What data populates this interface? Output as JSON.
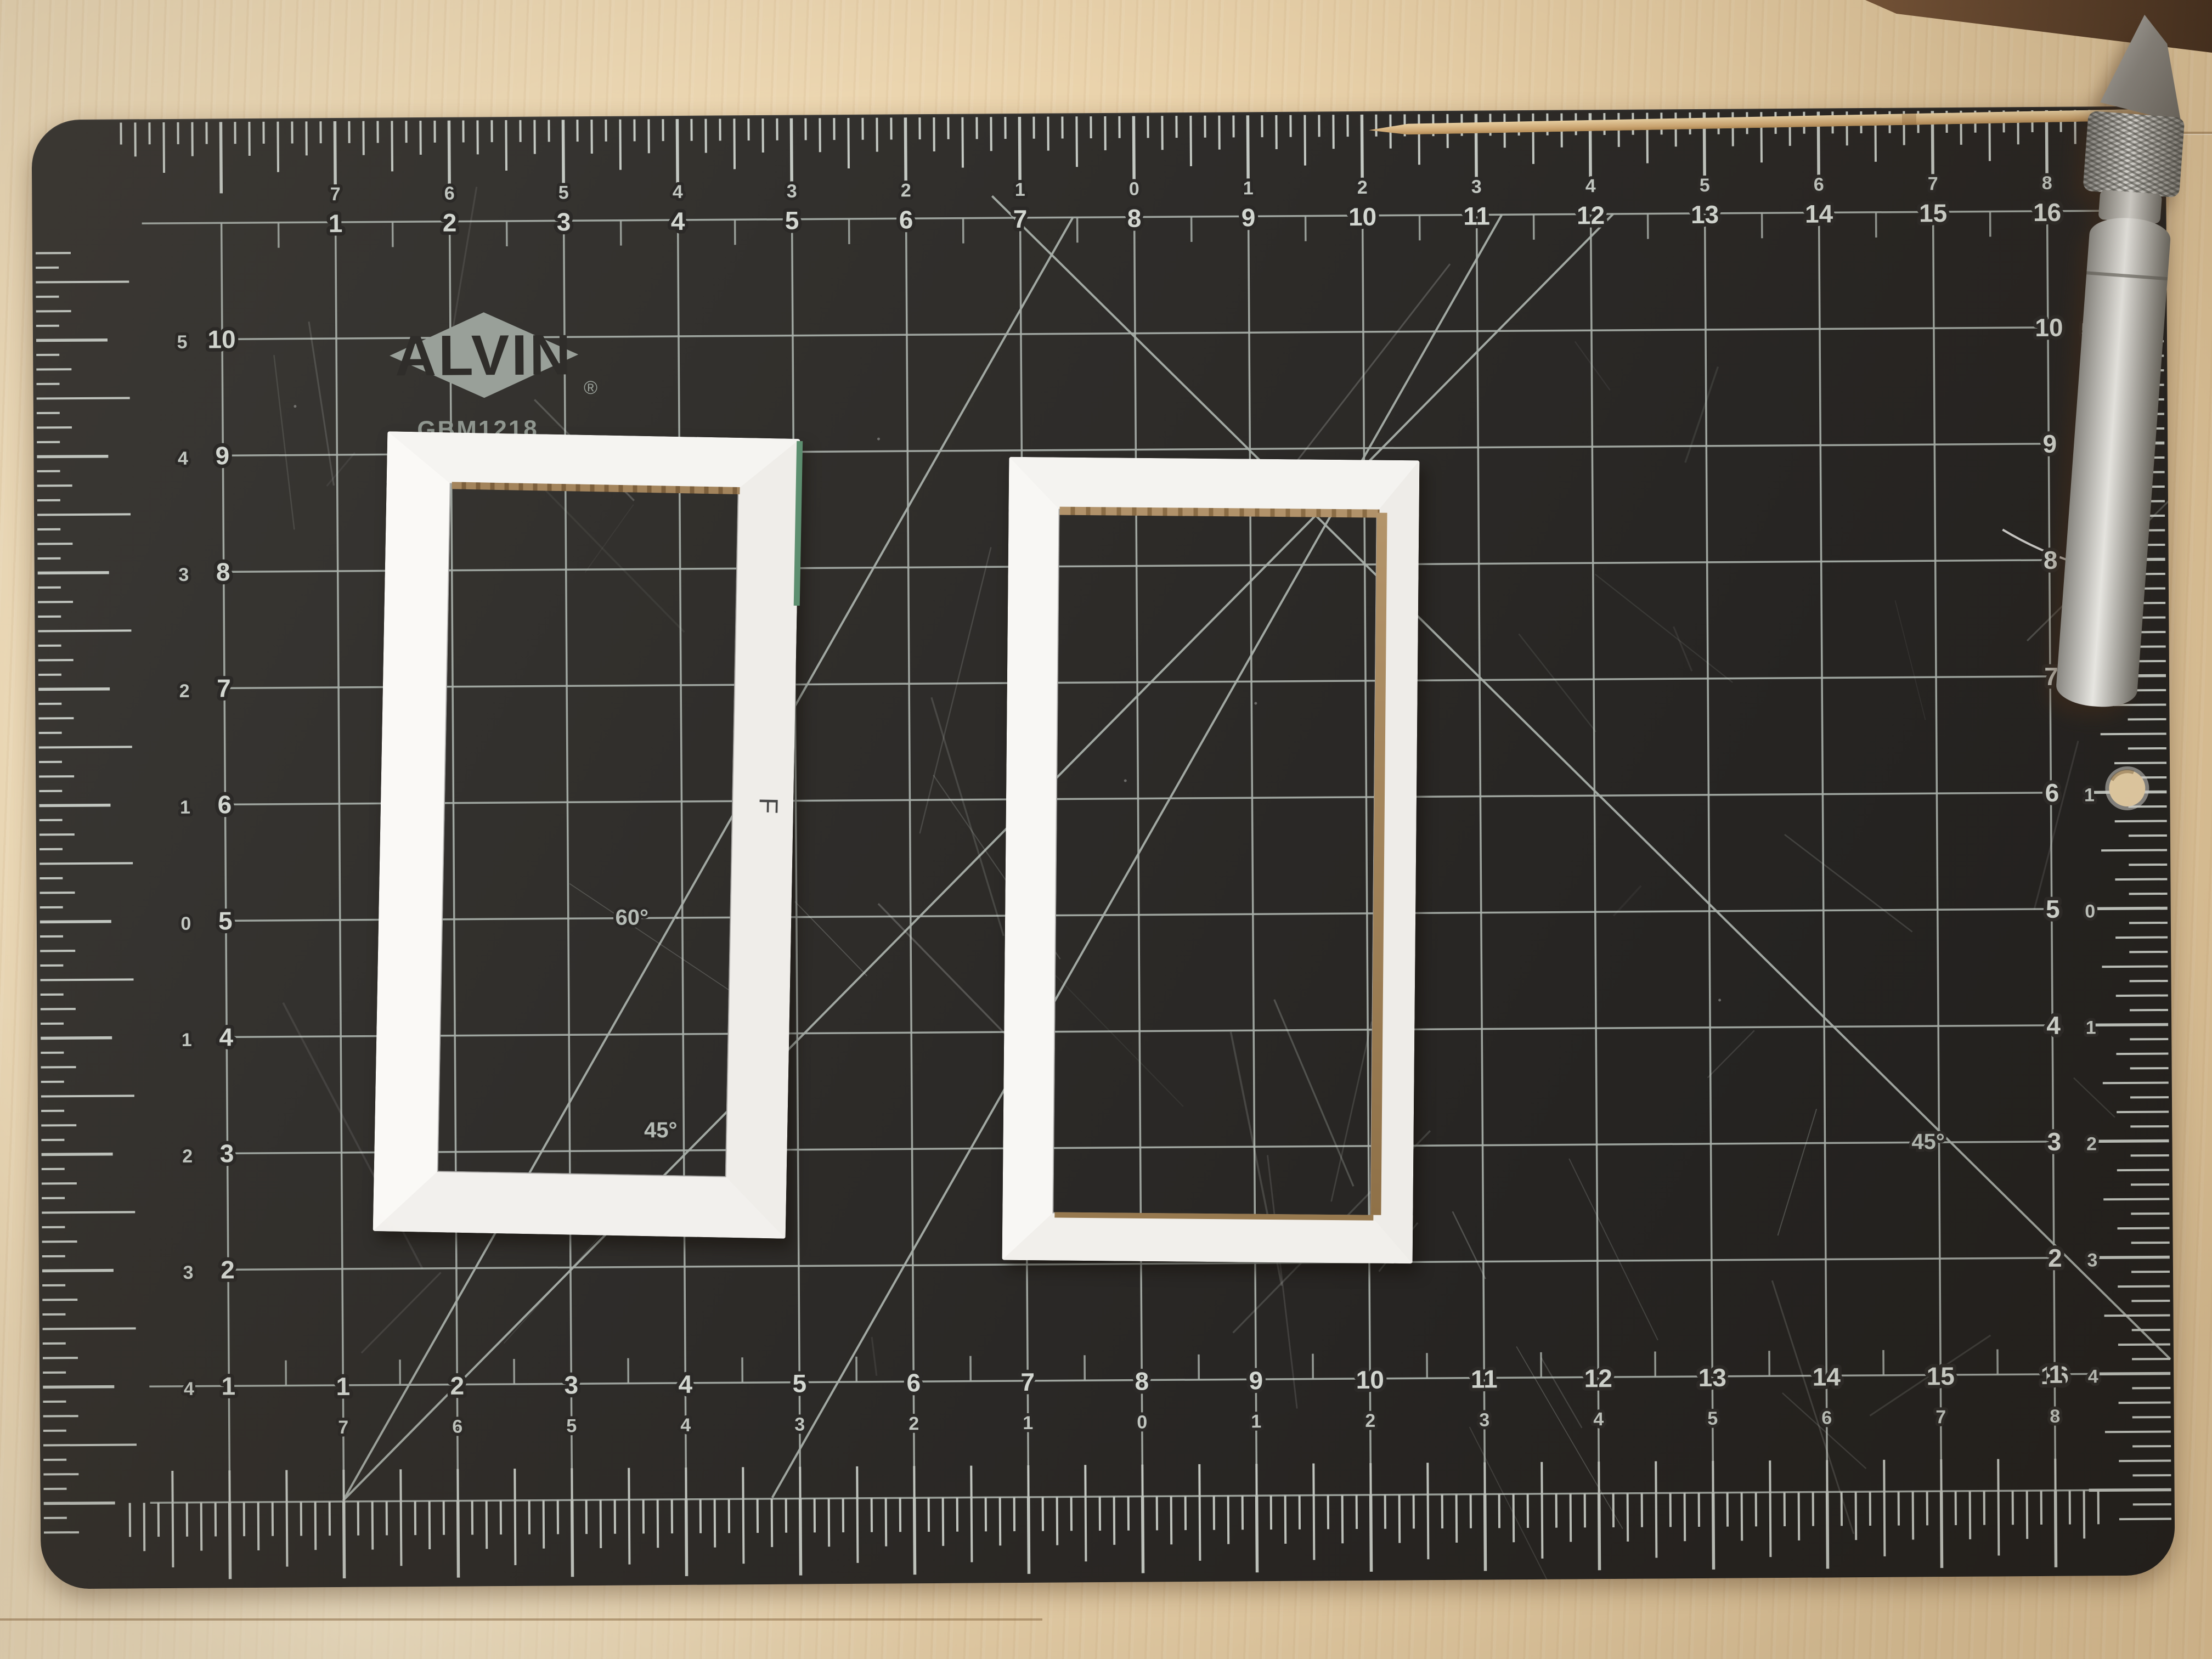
{
  "mat": {
    "brand": "ALVIN",
    "registered": "®",
    "model": "GBM1218",
    "partial_url": "www.alvinco.com",
    "angle_60": "60°",
    "angle_45_left": "45°",
    "angle_45_right": "45°",
    "surface_color": "#2b2927",
    "grid_color": "#a8afa9",
    "number_color": "#d3d7d1",
    "top_ruler": {
      "main": [
        1,
        2,
        3,
        4,
        5,
        6,
        7,
        8,
        9,
        10,
        11,
        12,
        13,
        14,
        15,
        16
      ],
      "centering": [
        7,
        6,
        5,
        4,
        3,
        2,
        1,
        0,
        1,
        2,
        3,
        4,
        5,
        6,
        7,
        8
      ]
    },
    "bottom_ruler": {
      "main": [
        1,
        2,
        3,
        4,
        5,
        6,
        7,
        8,
        9,
        10,
        11,
        12,
        13,
        14,
        15,
        16
      ],
      "centering": [
        7,
        6,
        5,
        4,
        3,
        2,
        1,
        0,
        1,
        2,
        3,
        4,
        5,
        6,
        7,
        8
      ]
    },
    "left_ruler": {
      "main": [
        10,
        9,
        8,
        7,
        6,
        5,
        4,
        3,
        2,
        1
      ],
      "centering": [
        5,
        4,
        3,
        2,
        1,
        0,
        1,
        2,
        3,
        4
      ]
    },
    "right_ruler": {
      "main": [
        10,
        9,
        8,
        7,
        6,
        5,
        4,
        3,
        2,
        1
      ],
      "centering": [
        5,
        4,
        3,
        2,
        1,
        0,
        1,
        2,
        3,
        4
      ]
    }
  },
  "frames": {
    "left": {
      "label": "F"
    }
  }
}
